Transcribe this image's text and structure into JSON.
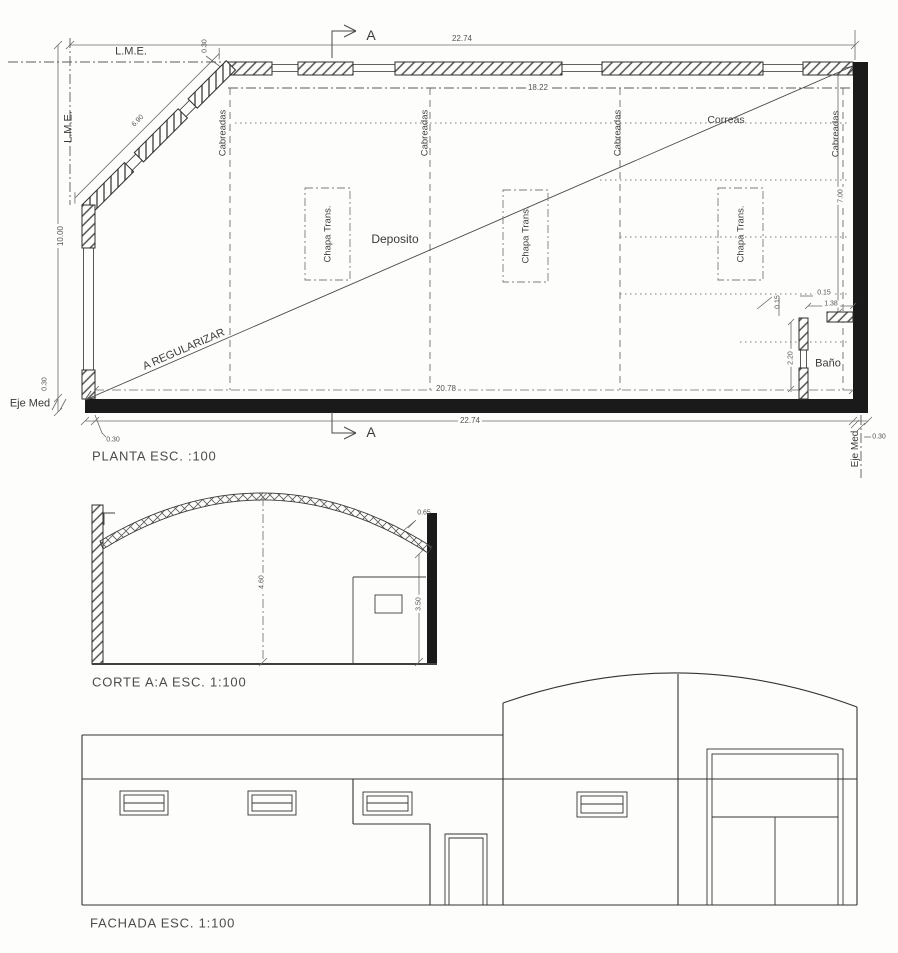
{
  "plan": {
    "title": "PLANTA ESC. :100",
    "section_marker": "A",
    "labels": {
      "lme": "L.M.E.",
      "eje_med": "Eje Med",
      "deposito": "Deposito",
      "bano": "Baño",
      "correas": "Correas",
      "cabreadas": "Cabreadas",
      "chapa_trans": "Chapa Trans.",
      "a_regularizar": "A REGULARIZAR"
    },
    "dims": {
      "total_width": "22.74",
      "inner_width": "18.22",
      "left_height": "10.00",
      "diagonal": "6.90",
      "wall_thickness": "0.30",
      "inner_bottom": "20.78",
      "right_height": "7.00",
      "bano_width": "1.38",
      "bano_wall": "0.15",
      "bano_depth": "2.20"
    }
  },
  "section": {
    "title": "CORTE A:A ESC. 1:100",
    "dims": {
      "clear_height": "4.60",
      "wall_height": "3.50",
      "truss_depth": "0.65"
    }
  },
  "facade": {
    "title": "FACHADA ESC. 1:100"
  },
  "colors": {
    "line": "#3f3f3f",
    "dim_line": "#6a6a6a",
    "wall_fill": "#1a1a1a",
    "paper": "#fdfdfb"
  }
}
